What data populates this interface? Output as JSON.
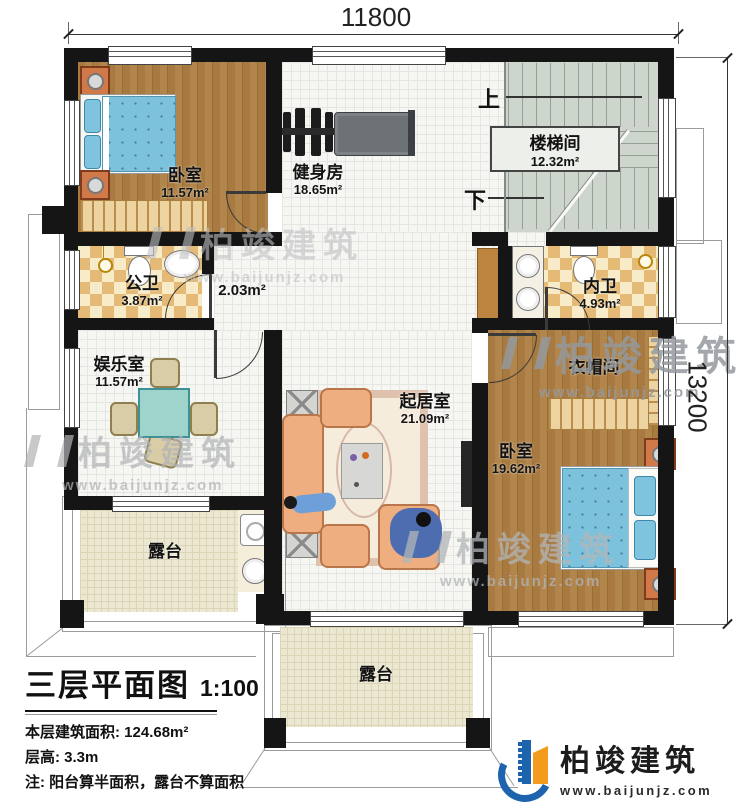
{
  "dims": {
    "width_top": "11800",
    "height_right": "13200"
  },
  "stairs": {
    "name": "楼梯间",
    "area": "12.32m²",
    "up": "上",
    "down": "下"
  },
  "rooms": {
    "bedroom1": {
      "name": "卧室",
      "area": "11.57m²"
    },
    "gym": {
      "name": "健身房",
      "area": "18.65m²"
    },
    "public_bath": {
      "name": "公卫",
      "area": "3.87m²"
    },
    "hallway": {
      "area": "2.03m²"
    },
    "private_bath": {
      "name": "内卫",
      "area": "4.93m²"
    },
    "entertainment": {
      "name": "娱乐室",
      "area": "11.57m²"
    },
    "living": {
      "name": "起居室",
      "area": "21.09m²"
    },
    "cloakroom": {
      "name": "衣帽间"
    },
    "bedroom2": {
      "name": "卧室",
      "area": "19.62m²"
    },
    "terrace_left": {
      "name": "露台"
    },
    "terrace_bottom": {
      "name": "露台"
    }
  },
  "title_block": {
    "title": "三层平面图",
    "scale": "1:100",
    "area_line": "本层建筑面积: 124.68m²",
    "height_line": "层高: 3.3m",
    "note_line": "注: 阳台算半面积，露台不算面积"
  },
  "branding": {
    "name": "柏竣建筑",
    "website": "www.baijunjz.com"
  },
  "watermark": {
    "name": "柏竣建筑",
    "website": "www.baijunjz.com"
  },
  "colors": {
    "wall": "#151515",
    "wood": "#a97c42",
    "tile": "#f6f6f3",
    "checker": "#e9c584",
    "stair": "#ced5cd",
    "terrace": "#ece7d1",
    "logo_blue": "#1e63ad",
    "logo_orange": "#f29b1d"
  }
}
